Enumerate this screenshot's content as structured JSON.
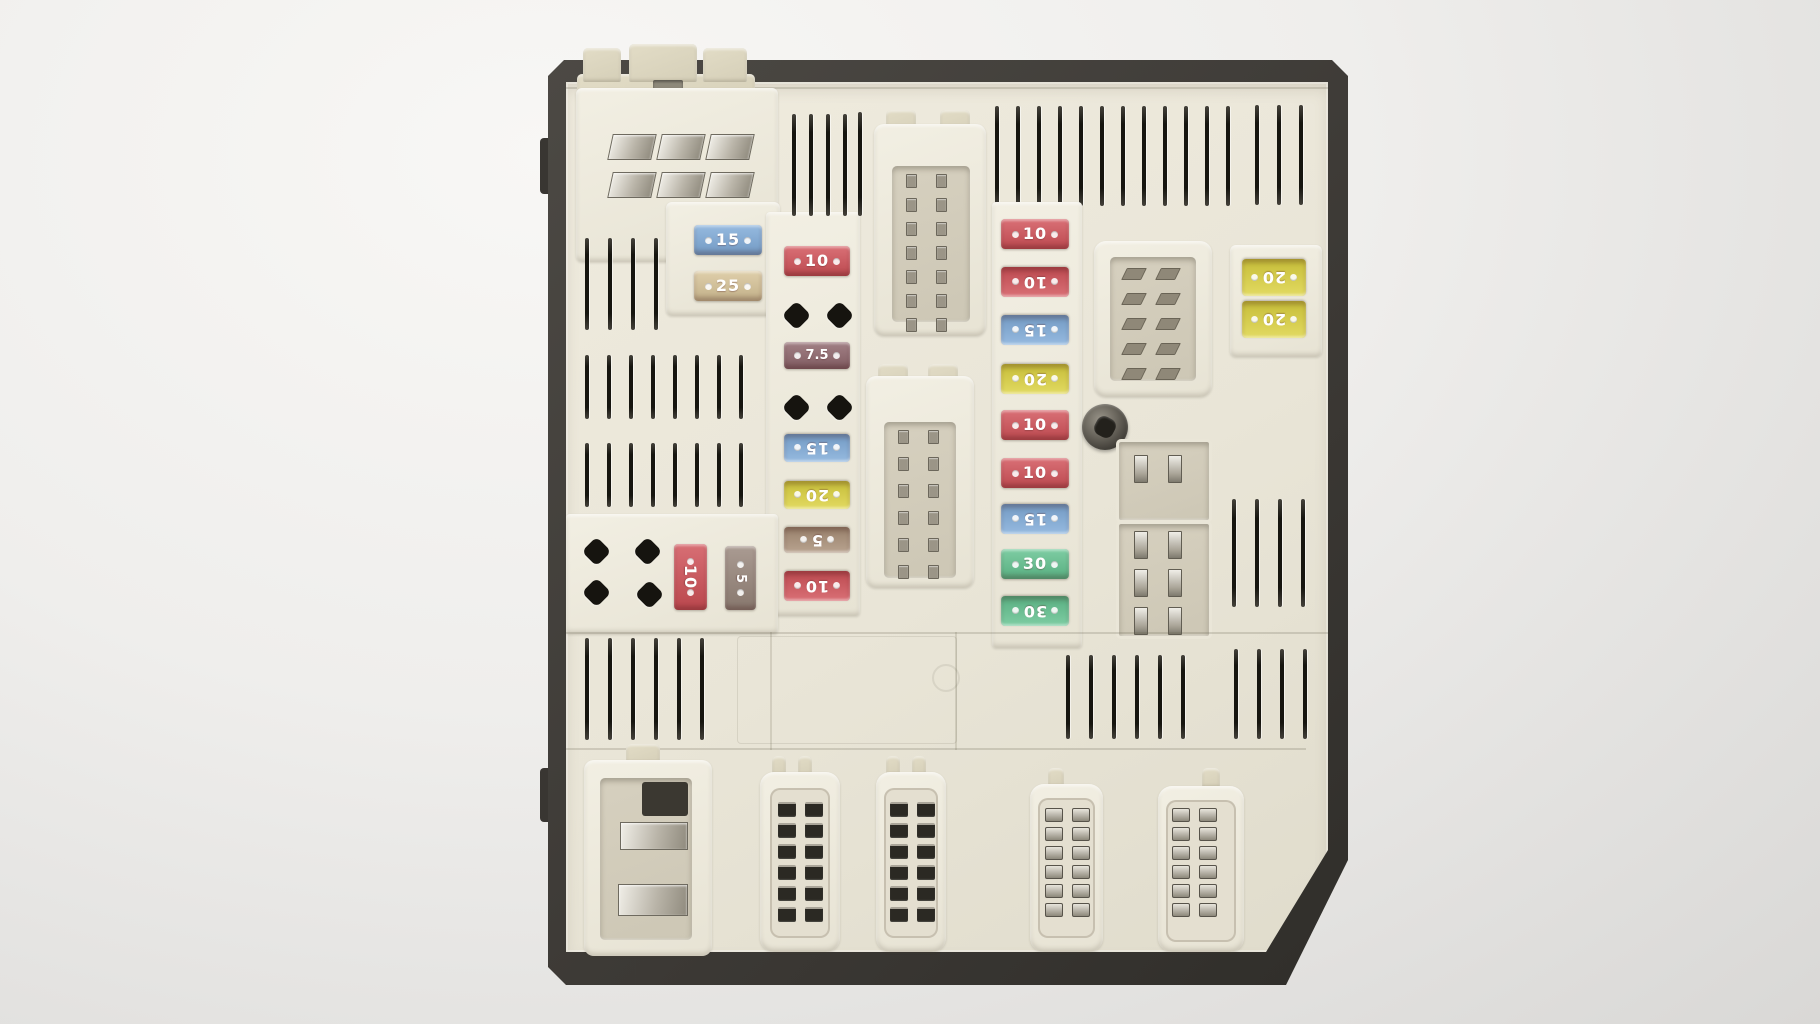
{
  "scene": {
    "subject": "automotive engine-bay fuse and relay box, top view, studio photo",
    "background_color": "#efeeec",
    "shell_color": "#3d3a36",
    "plastic_color": "#e9e5d7"
  },
  "colors": {
    "fuse_red": "#d15158",
    "fuse_blue": "#7fabd9",
    "fuse_tan": "#d8c498",
    "fuse_maroon": "#8e656b",
    "fuse_yellow": "#dcd23f",
    "fuse_green": "#62c28f",
    "fuse_brown": "#a98f77",
    "fuse_brown_dark": "#97857a",
    "fuse_text": "#ffffff",
    "vent_slot": "#16150f",
    "metal_terminal": "#b9b4a8"
  },
  "fuses": {
    "top_left_pair": [
      {
        "label": "15",
        "color": "#7fabd9"
      },
      {
        "label": "25",
        "color": "#d8c498"
      }
    ],
    "left_column": [
      {
        "label": "10",
        "color": "#d15158"
      },
      {
        "label": "7.5",
        "color": "#8e656b"
      },
      {
        "label": "15",
        "color": "#7fabd9"
      },
      {
        "label": "20",
        "color": "#dcd23f"
      },
      {
        "label": "5",
        "color": "#a98f77"
      },
      {
        "label": "10",
        "color": "#d15158"
      }
    ],
    "side_vertical_pair": [
      {
        "label": "10",
        "color": "#cf4f56"
      },
      {
        "label": "5",
        "color": "#97857a"
      }
    ],
    "middle_column": [
      {
        "label": "10",
        "color": "#d15158"
      },
      {
        "label": "10",
        "color": "#d15158"
      },
      {
        "label": "15",
        "color": "#7fabd9"
      },
      {
        "label": "20",
        "color": "#dcd23f"
      },
      {
        "label": "10",
        "color": "#d15158"
      },
      {
        "label": "10",
        "color": "#d15158"
      },
      {
        "label": "15",
        "color": "#7fabd9"
      },
      {
        "label": "30",
        "color": "#62c28f"
      },
      {
        "label": "30",
        "color": "#62c28f"
      }
    ],
    "right_pair": [
      {
        "label": "20",
        "color": "#dcd23f"
      },
      {
        "label": "20",
        "color": "#dcd23f"
      }
    ]
  },
  "connectors": {
    "bottom_row": [
      {
        "name": "left-power-connector",
        "blade_terminals": 2
      },
      {
        "name": "multi-pin-connector-1",
        "pin_columns": 2,
        "pin_rows": 6
      },
      {
        "name": "multi-pin-connector-2",
        "pin_columns": 2,
        "pin_rows": 6
      },
      {
        "name": "multi-pin-connector-3",
        "pin_columns": 2,
        "pin_rows": 6
      },
      {
        "name": "multi-pin-connector-4",
        "pin_columns": 2,
        "pin_rows": 6
      }
    ],
    "relay_socket_blades": 8,
    "top_left_contact_pads": 6
  }
}
